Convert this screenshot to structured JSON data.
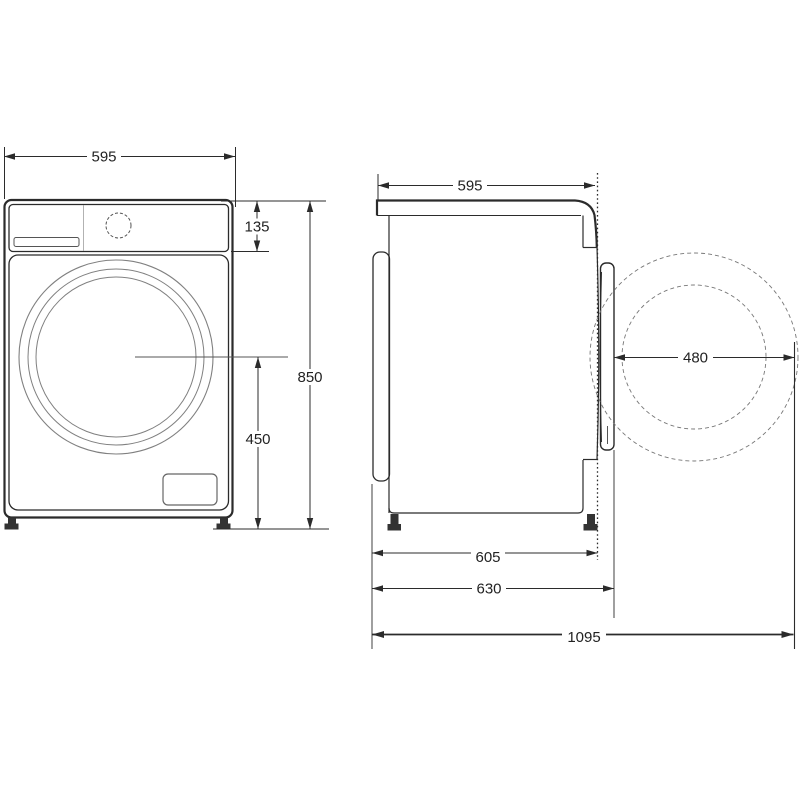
{
  "page": {
    "title": "Washing machine dimension drawing",
    "background_color": "#ffffff",
    "line_color": "#2b2b2b"
  },
  "front_view": {
    "name": "washer-front-view",
    "dims": {
      "width": "595",
      "control_panel_height": "135",
      "overall_height": "850",
      "door_center_height": "450"
    }
  },
  "side_view": {
    "name": "washer-side-view",
    "dims": {
      "depth_top": "595",
      "door_swing_diameter": "480",
      "depth_body": "605",
      "depth_overall": "630",
      "depth_with_door_open": "1095"
    }
  }
}
